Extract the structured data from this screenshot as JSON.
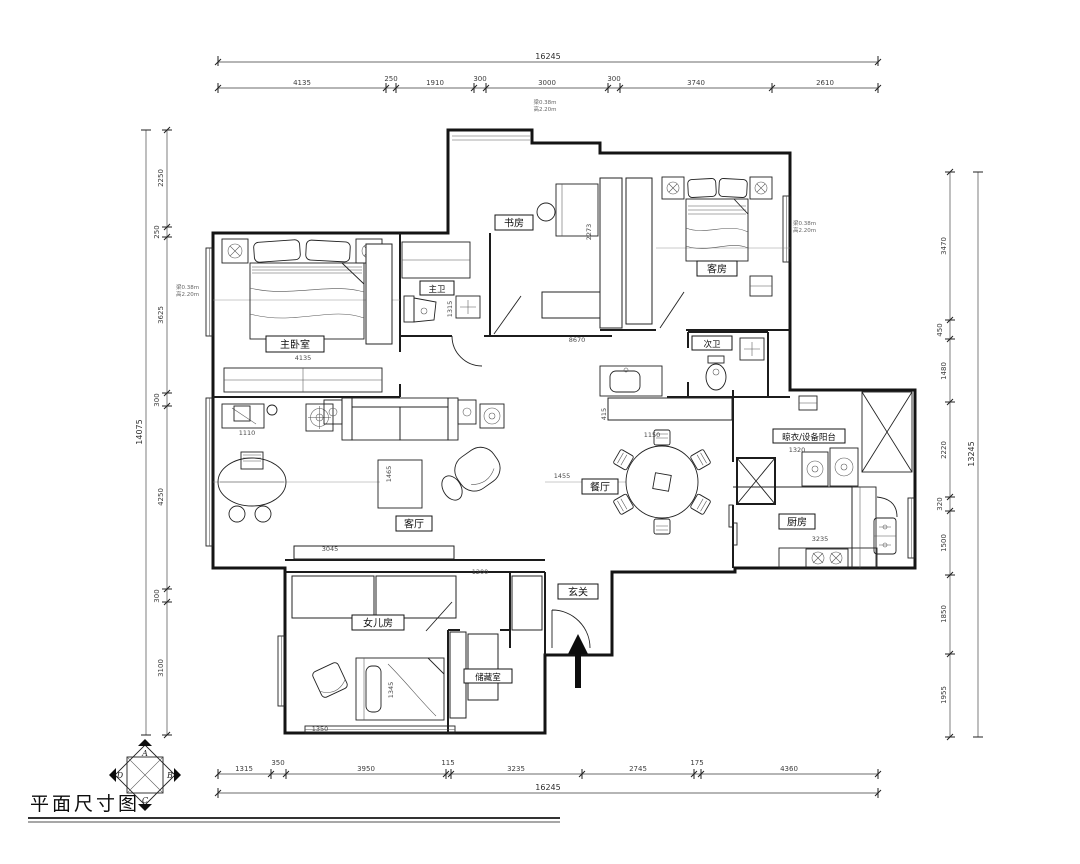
{
  "title": "平面尺寸图",
  "compass": {
    "top": "A",
    "right": "B",
    "bottom": "C",
    "left": "D"
  },
  "rooms": {
    "master_bedroom": "主卧室",
    "master_bath": "主卫",
    "study": "书房",
    "guest_room": "客房",
    "second_bath": "次卫",
    "living_room": "客厅",
    "dining_room": "餐厅",
    "kitchen": "厨房",
    "laundry_balcony": "晾衣/设备阳台",
    "entry": "玄关",
    "daughter_room": "女儿房",
    "storage": "储藏室"
  },
  "dimensions": {
    "top": {
      "total": "16245",
      "segments": [
        "4135",
        "250",
        "1910",
        "300",
        "3000",
        "300",
        "3740",
        "2610"
      ]
    },
    "bottom": {
      "total": "16245",
      "segments": [
        "1315",
        "350",
        "3950",
        "115",
        "3235",
        "2745",
        "175",
        "4360"
      ]
    },
    "left": {
      "total": "14075",
      "segments": [
        "2250",
        "250",
        "3625",
        "300",
        "4250",
        "300",
        "3100"
      ]
    },
    "right": {
      "total": "13245",
      "segments": [
        "3470",
        "450",
        "1480",
        "2220",
        "320",
        "1500",
        "1850",
        "1955"
      ]
    }
  },
  "interior_dims": [
    "4135",
    "1110",
    "8670",
    "2273",
    "1455",
    "1150",
    "1320",
    "3235",
    "1200",
    "3045",
    "1345",
    "1350",
    "1315",
    "415",
    "1465"
  ],
  "notes": {
    "beam": "梁0.38m",
    "height": "高2.20m"
  }
}
